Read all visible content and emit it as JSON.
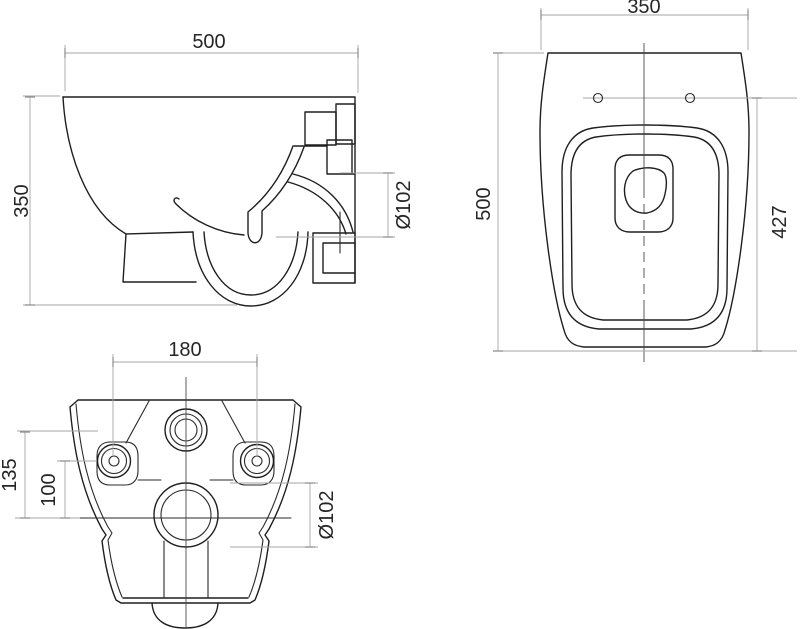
{
  "drawing": {
    "views": {
      "side": {
        "label_width": "500",
        "label_height": "350",
        "label_outlet_diameter": "Ø102"
      },
      "front": {
        "label_width": "350",
        "label_height": "500",
        "label_mount_height": "427"
      },
      "bottom": {
        "label_hole_spacing": "180",
        "label_offset_long": "135",
        "label_offset_short": "100",
        "label_drain_diameter": "Ø102"
      }
    },
    "colors": {
      "geometry": "#1f1f1f",
      "dimension_lines": "#a6a6a6",
      "label_text": "#262626",
      "background": "#ffffff"
    }
  }
}
